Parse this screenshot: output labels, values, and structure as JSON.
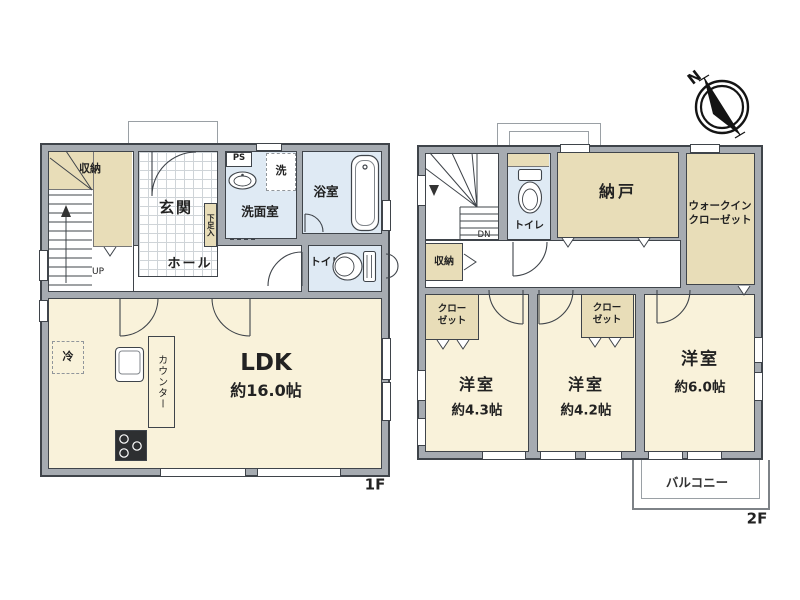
{
  "colors": {
    "wall": "#a6abb1",
    "line": "#3f444a",
    "cream": "#f9f2da",
    "tan": "#e8ddb8",
    "blue": "#dfeaf4",
    "tileln": "#cfd4d8"
  },
  "floor1": {
    "floor_label": "1F",
    "storage": "収納",
    "up": "UP",
    "entrance": "玄関",
    "shoe_cabinet": "下足入",
    "ps": "PS",
    "washer": "洗",
    "washroom": "洗面室",
    "bathroom": "浴室",
    "hall": "ホール",
    "toilet": "トイレ",
    "ldk": "LDK",
    "ldk_size": "約16.0帖",
    "counter": "カウンター",
    "fridge": "冷"
  },
  "floor2": {
    "floor_label": "2F",
    "dn": "DN",
    "toilet": "トイレ",
    "storage_room": "納戸",
    "walk_in_closet_line1": "ウォークイン",
    "walk_in_closet_line2": "クローゼット",
    "storage": "収納",
    "closet_line1": "クロー",
    "closet_line2": "ゼット",
    "bedroom": "洋室",
    "bedroom1_size": "約4.3帖",
    "bedroom2_size": "約4.2帖",
    "bedroom3_size": "約6.0帖",
    "balcony": "バルコニー"
  },
  "compass": {
    "north": "N"
  }
}
